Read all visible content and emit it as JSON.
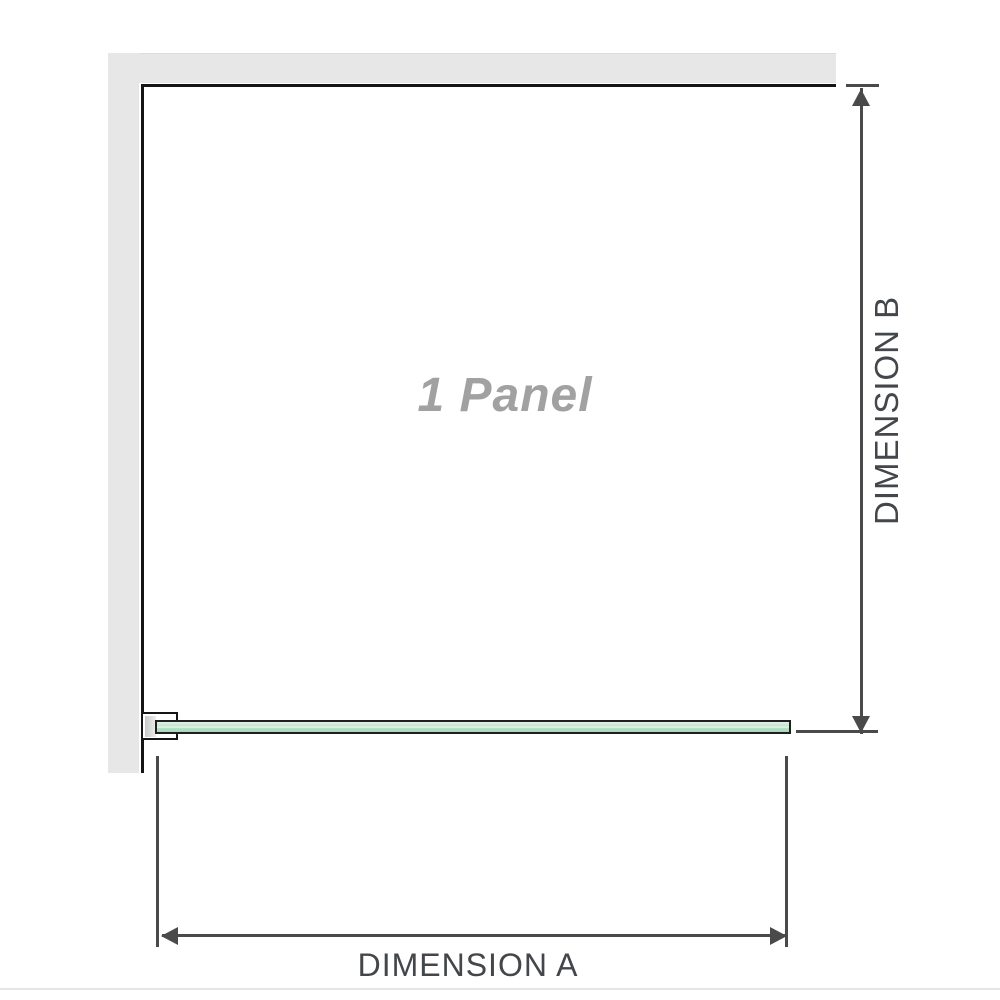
{
  "diagram": {
    "panel_label": "1 Panel",
    "dimension_a_label": "DIMENSION A",
    "dimension_b_label": "DIMENSION B",
    "colors": {
      "wall": "#e7e7e7",
      "outline": "#151515",
      "dimension": "#4a4a4a",
      "dimension_text": "#43474b",
      "label_gray": "#a1a1a1",
      "glass_edge": "#1f1f1f",
      "glass_fill": "#b9e3c8",
      "baseline_rule": "#e4e6e2"
    }
  }
}
